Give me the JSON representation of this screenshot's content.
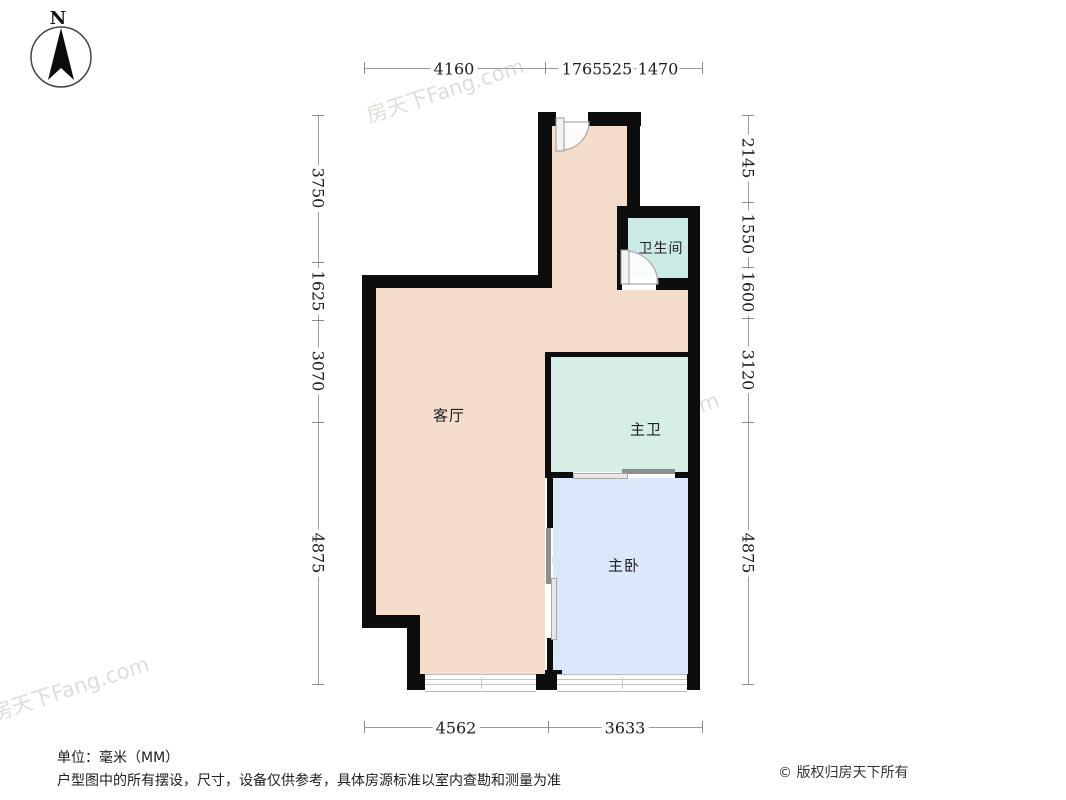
{
  "compass": {
    "north": "N"
  },
  "rooms": {
    "living": "客厅",
    "bath": "卫生间",
    "master_bath": "主卫",
    "master_bed": "主卧"
  },
  "dimensions": {
    "top": [
      "4160",
      "1765",
      "525",
      "1470"
    ],
    "left": [
      "3750",
      "1625",
      "3070",
      "4875"
    ],
    "right": [
      "2145",
      "1550",
      "1600",
      "3120",
      "4875"
    ],
    "bottom": [
      "4562",
      "3633"
    ]
  },
  "footer": {
    "unit": "单位：毫米（MM）",
    "disclaimer": "户型图中的所有摆设，尺寸，设备仅供参考，具体房源标准以室内查勘和测量为准",
    "copyright": "© 版权归房天下所有"
  },
  "watermark": {
    "text": "房天下Fang.com"
  },
  "colors": {
    "wall": "#0d0d0d",
    "living_fill": "#f4decb",
    "bath_fill": "#cdebe6",
    "master_bath_fill": "#d6eee5",
    "master_bed_fill": "#dbe7fa",
    "dimension_line": "#9a9a9a"
  }
}
